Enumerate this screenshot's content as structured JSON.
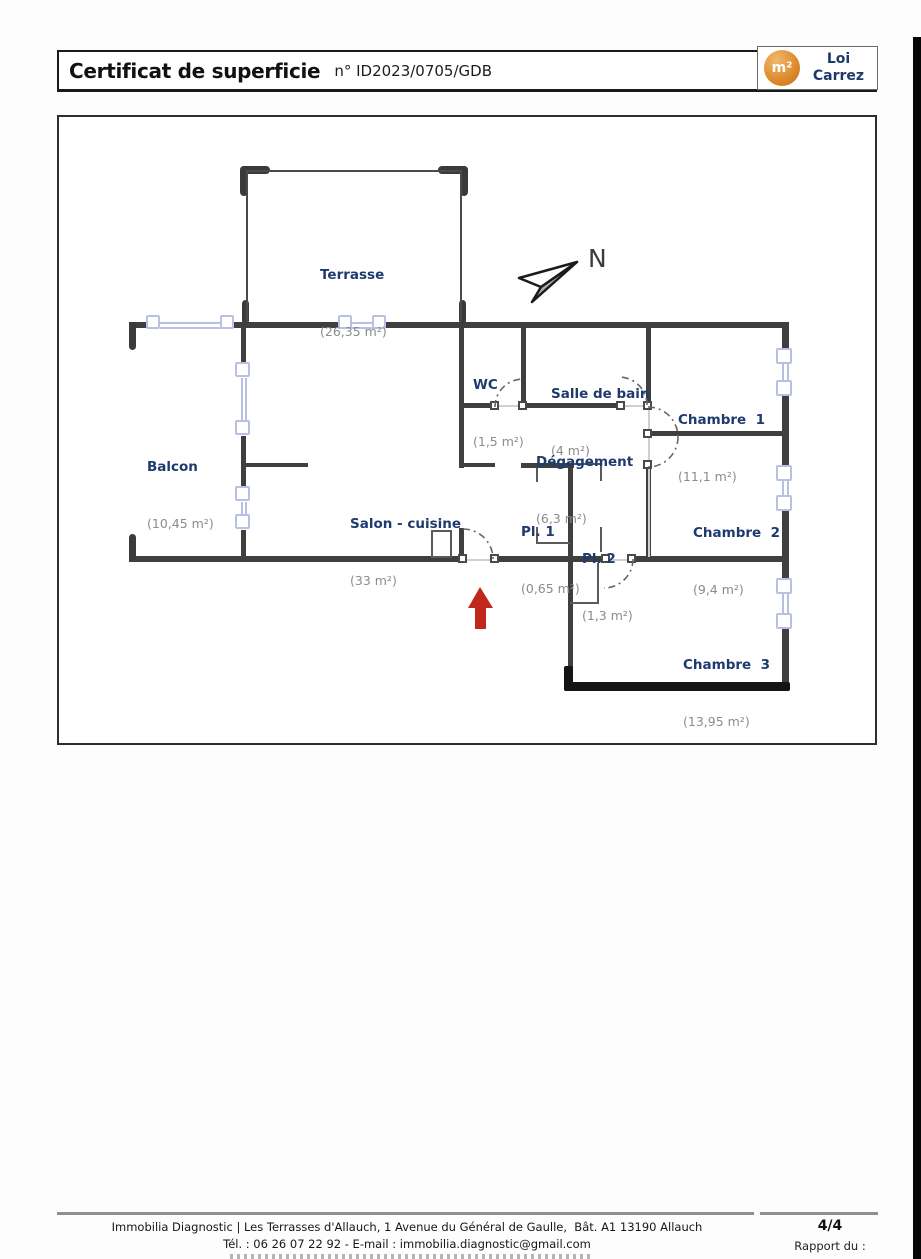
{
  "header": {
    "title": "Certificat de superficie",
    "number": "n° ID2023/0705/GDB"
  },
  "badge": {
    "symbol": "m²",
    "line1": "Loi",
    "line2": "Carrez"
  },
  "compass": {
    "label": "N"
  },
  "rooms": [
    {
      "id": "terrasse",
      "name": "Terrasse",
      "area": "(26,35 m²)"
    },
    {
      "id": "balcon",
      "name": "Balcon",
      "area": "(10,45 m²)"
    },
    {
      "id": "salon",
      "name": "Salon - cuisine",
      "area": "(33 m²)"
    },
    {
      "id": "wc",
      "name": "WC",
      "area": "(1,5 m²)"
    },
    {
      "id": "sdb",
      "name": "Salle de bain",
      "area": "(4 m²)"
    },
    {
      "id": "degagement",
      "name": "Dégagement",
      "area": "(6,3 m²)"
    },
    {
      "id": "chambre1",
      "name": "Chambre  1",
      "area": "(11,1 m²)"
    },
    {
      "id": "chambre2",
      "name": "Chambre  2",
      "area": "(9,4 m²)"
    },
    {
      "id": "chambre3",
      "name": "Chambre  3",
      "area": "(13,95 m²)"
    },
    {
      "id": "pl1",
      "name": "Pl. 1",
      "area": "(0,65 m²)"
    },
    {
      "id": "pl2",
      "name": "Pl. 2",
      "area": "(1,3 m²)"
    }
  ],
  "footer": {
    "line1": "Immobilia Diagnostic | Les Terrasses d'Allauch, 1 Avenue du Général de Gaulle,  Bât. A1 13190 Allauch",
    "line2": "Tél. : 06 26 07 22 92 - E-mail : immobilia.diagnostic@gmail.com",
    "page": "4/4",
    "report_label": "Rapport du :"
  },
  "colors": {
    "room_name": "#1e3a6e",
    "room_area": "#8c8c8c",
    "wall": "#3f3f3f",
    "window": "#b9c0e4",
    "entrance_arrow": "#c1271b",
    "badge_orange": "#dd8a2e"
  }
}
